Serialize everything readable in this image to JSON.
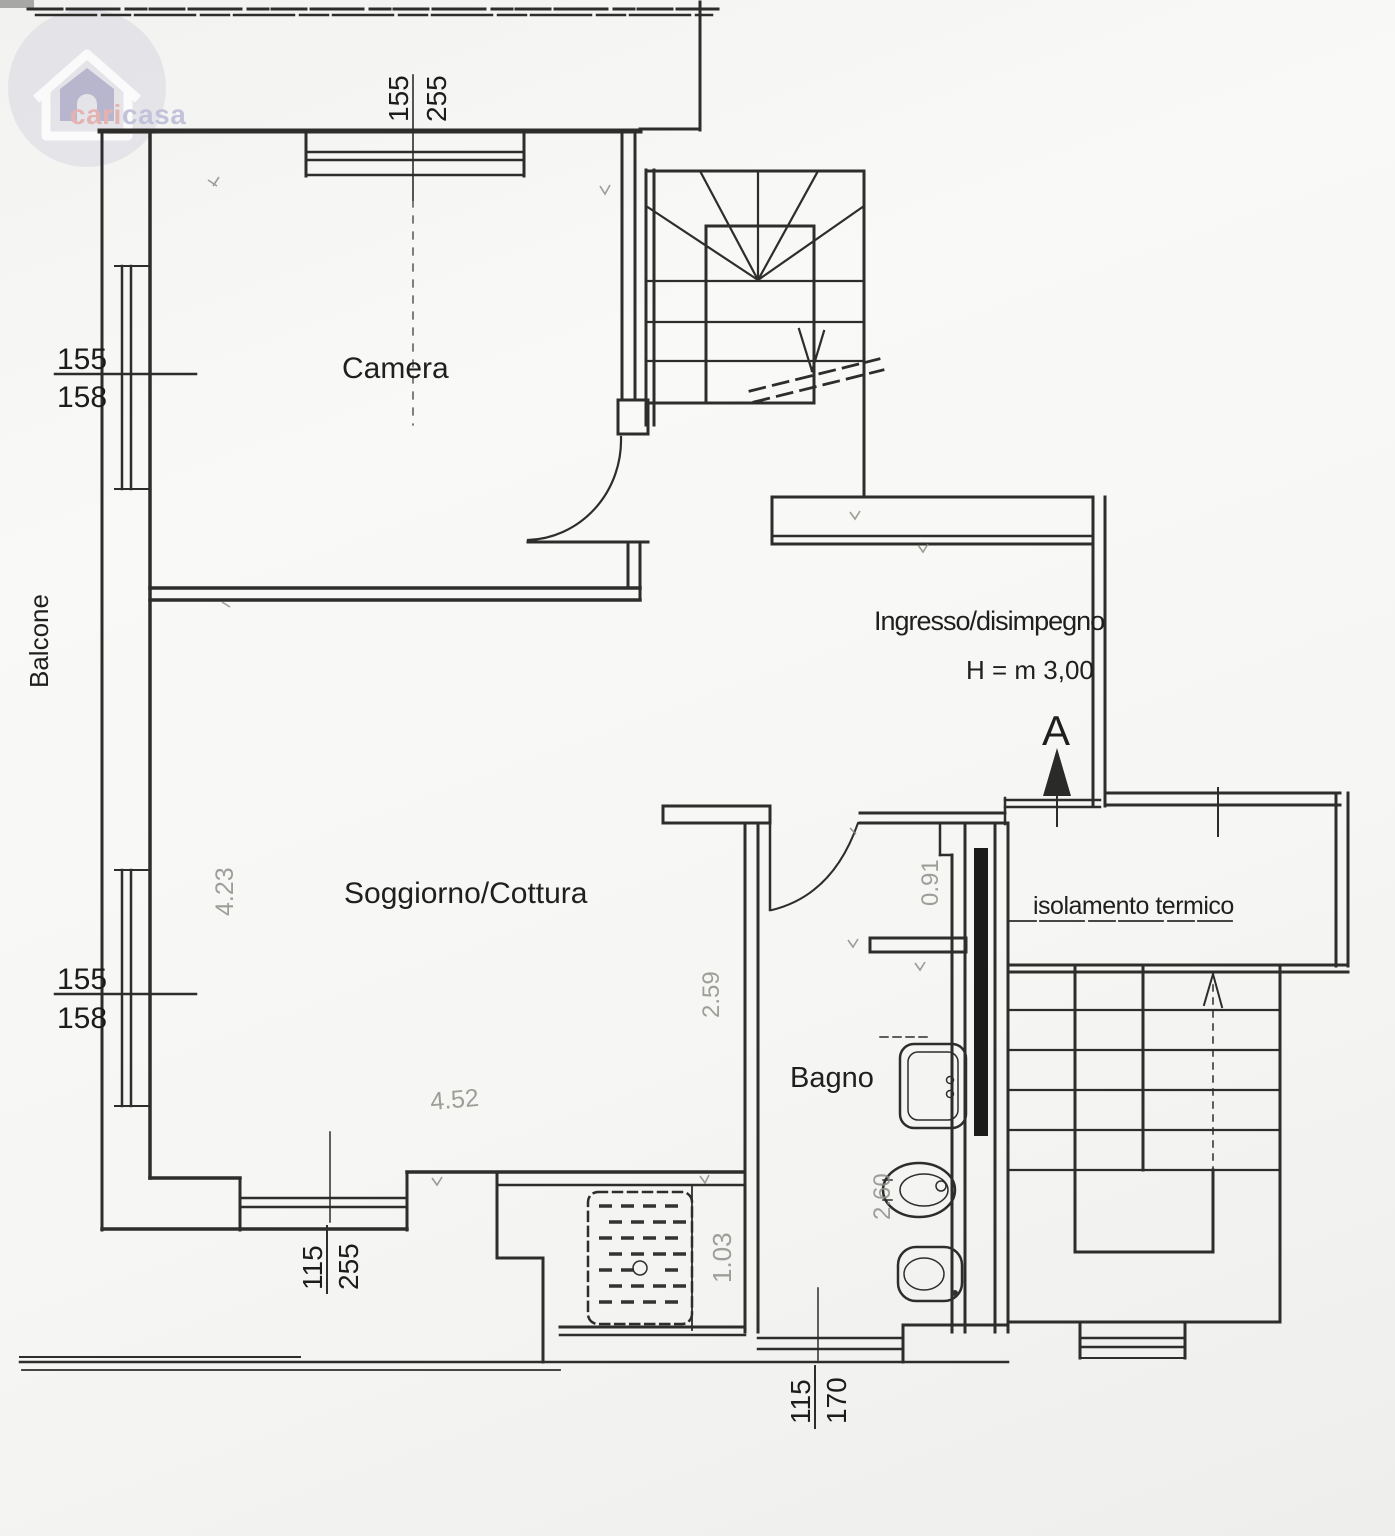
{
  "logo": {
    "brand_left": "cari",
    "brand_right": "casa"
  },
  "room_labels": {
    "camera": "Camera",
    "soggiorno_cottura": "Soggiorno/Cottura",
    "bagno": "Bagno",
    "ingresso_disimpegno": "Ingresso/disimpegno",
    "balcone": "Balcone"
  },
  "annotations": {
    "ceiling_height": "H = m 3,00",
    "section_marker": "A",
    "insulation_note": "isolamento termico"
  },
  "window_dimensions": {
    "top": {
      "width": "155",
      "height": "255"
    },
    "left_upper": {
      "width": "155",
      "height": "158"
    },
    "left_lower": {
      "width": "155",
      "height": "158"
    },
    "bottom": {
      "width": "115",
      "height": "255"
    },
    "bagno": {
      "width": "115",
      "height": "170"
    }
  },
  "pencil_measurements": {
    "soggiorno_left": "4.23",
    "soggiorno_bottom": "4.52",
    "soggiorno_right": "2.59",
    "corridor": "1.03",
    "bagno_door": "0.91",
    "bagno_right": "2.60"
  },
  "colors": {
    "line": "#2d2d2b",
    "paper": "#f6f6f4",
    "pencil_gray": "#8f8f8a",
    "insulation_fill": "#1b1b19",
    "logo_circle": "#cfcddd",
    "logo_house_inner": "#9e9abd",
    "logo_text_cari": "#dfa2a0",
    "logo_text_casa": "#b4b6d4"
  }
}
